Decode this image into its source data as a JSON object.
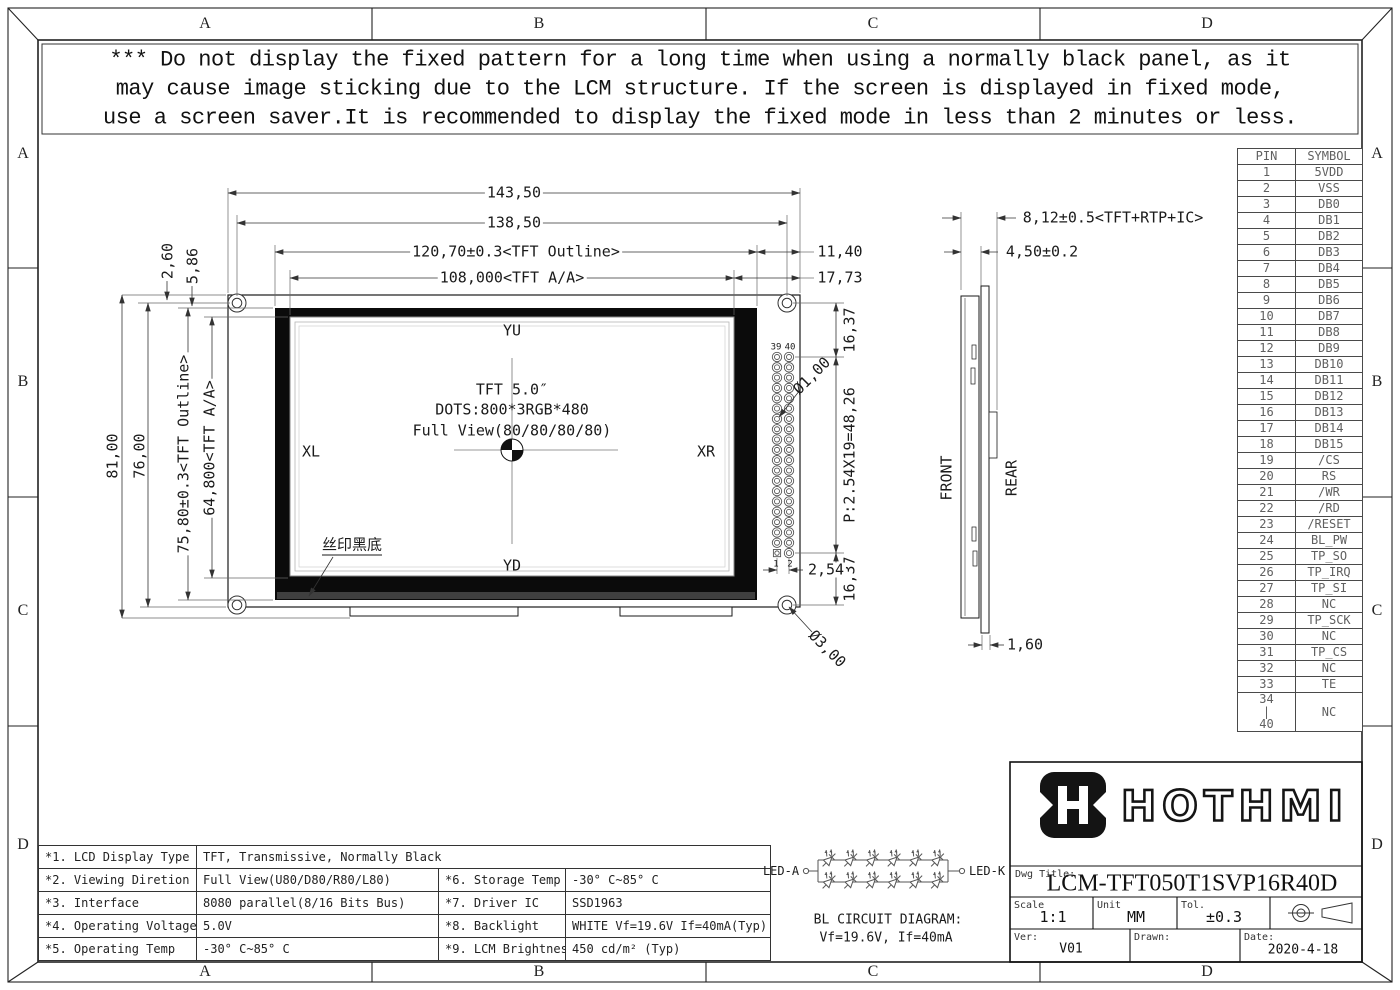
{
  "drawing": {
    "zones_top": [
      "A",
      "B",
      "C",
      "D"
    ],
    "zones_bottom": [
      "A",
      "B",
      "C",
      "D"
    ],
    "zones_left": [
      "A",
      "B",
      "C",
      "D"
    ],
    "zones_right": [
      "A",
      "B",
      "C",
      "D"
    ]
  },
  "warning": {
    "line1": "*** Do not display the fixed pattern for a long time when using a normally black panel, as it",
    "line2": "may cause image sticking due to the LCM structure. If the screen is displayed in fixed mode,",
    "line3": "use a screen saver.It is recommended to display the fixed mode in less than 2 minutes or less."
  },
  "front_view": {
    "label_yu": "YU",
    "label_yd": "YD",
    "label_xl": "XL",
    "label_xr": "XR",
    "panel_line1": "TFT 5.0″",
    "panel_line2": "DOTS:800*3RGB*480",
    "panel_line3": "Full View(80/80/80/80)",
    "silkprint": "丝印黑底",
    "pin39": "39",
    "pin40": "40",
    "pin1": "1",
    "pin2": "2"
  },
  "dims": {
    "w_total": "143,50",
    "w_holes": "138,50",
    "w_tft": "120,70±0.3<TFT Outline>",
    "w_aa": "108,000<TFT A/A>",
    "w_right1": "11,40",
    "w_right2": "17,73",
    "h_top1": "2,60",
    "h_top2": "5,86",
    "h_total": "81,00",
    "h_holes": "76,00",
    "h_tft": "75,80±0.3<TFT Outline>",
    "h_aa": "64,800<TFT A/A>",
    "conn_top": "16,37",
    "conn_pitch": "P:2.54X19=48,26",
    "conn_bottom": "16,37",
    "conn_pitch_h": "2,54",
    "dia_pin": "Ø1,00",
    "dia_hole": "Ø3,00",
    "t_total": "8,12±0.5<TFT+RTP+IC>",
    "t_front": "4,50±0.2",
    "t_pcb": "1,60"
  },
  "side_view": {
    "front": "FRONT",
    "rear": "REAR"
  },
  "pin_table": {
    "h_pin": "PIN",
    "h_symbol": "SYMBOL",
    "rows": [
      {
        "pin": "1",
        "symbol": "5VDD"
      },
      {
        "pin": "2",
        "symbol": "VSS"
      },
      {
        "pin": "3",
        "symbol": "DB0"
      },
      {
        "pin": "4",
        "symbol": "DB1"
      },
      {
        "pin": "5",
        "symbol": "DB2"
      },
      {
        "pin": "6",
        "symbol": "DB3"
      },
      {
        "pin": "7",
        "symbol": "DB4"
      },
      {
        "pin": "8",
        "symbol": "DB5"
      },
      {
        "pin": "9",
        "symbol": "DB6"
      },
      {
        "pin": "10",
        "symbol": "DB7"
      },
      {
        "pin": "11",
        "symbol": "DB8"
      },
      {
        "pin": "12",
        "symbol": "DB9"
      },
      {
        "pin": "13",
        "symbol": "DB10"
      },
      {
        "pin": "14",
        "symbol": "DB11"
      },
      {
        "pin": "15",
        "symbol": "DB12"
      },
      {
        "pin": "16",
        "symbol": "DB13"
      },
      {
        "pin": "17",
        "symbol": "DB14"
      },
      {
        "pin": "18",
        "symbol": "DB15"
      },
      {
        "pin": "19",
        "symbol": "/CS"
      },
      {
        "pin": "20",
        "symbol": "RS"
      },
      {
        "pin": "21",
        "symbol": "/WR"
      },
      {
        "pin": "22",
        "symbol": "/RD"
      },
      {
        "pin": "23",
        "symbol": "/RESET"
      },
      {
        "pin": "24",
        "symbol": "BL_PW"
      },
      {
        "pin": "25",
        "symbol": "TP_SO"
      },
      {
        "pin": "26",
        "symbol": "TP_IRQ"
      },
      {
        "pin": "27",
        "symbol": "TP_SI"
      },
      {
        "pin": "28",
        "symbol": "NC"
      },
      {
        "pin": "29",
        "symbol": "TP_SCK"
      },
      {
        "pin": "30",
        "symbol": "NC"
      },
      {
        "pin": "31",
        "symbol": "TP_CS"
      },
      {
        "pin": "32",
        "symbol": "NC"
      },
      {
        "pin": "33",
        "symbol": "TE"
      },
      {
        "pin": "34\n|\n40",
        "symbol": "NC"
      }
    ]
  },
  "spec_table": {
    "r1c1": "*1. LCD Display Type",
    "r1c2": "TFT, Transmissive, Normally Black",
    "r2c1": "*2. Viewing Diretion",
    "r2c2": "Full View(U80/D80/R80/L80)",
    "r2c3": "*6. Storage Temp",
    "r2c4": "-30° C~85° C",
    "r3c1": "*3. Interface",
    "r3c2": "8080 parallel(8/16 Bits Bus)",
    "r3c3": "*7. Driver IC",
    "r3c4": "SSD1963",
    "r4c1": "*4. Operating Voltage",
    "r4c2": "5.0V",
    "r4c3": "*8. Backlight",
    "r4c4": "WHITE Vf=19.6V If=40mA(Typ)",
    "r5c1": "*5. Operating Temp",
    "r5c2": "-30° C~85° C",
    "r5c3": "*9. LCM Brightness",
    "r5c4": "450 cd/m² (Typ)"
  },
  "bl_circuit": {
    "led_a": "LED-A",
    "led_k": "LED-K",
    "title": "BL CIRCUIT DIAGRAM:",
    "subtitle": "Vf=19.6V, If=40mA"
  },
  "title_block": {
    "brand": "HOTHMI",
    "dwg_title_label": "Dwg Title:",
    "dwg_title": "LCM-TFT050T1SVP16R40D",
    "scale_label": "Scale",
    "scale": "1:1",
    "unit_label": "Unit",
    "unit": "MM",
    "tol_label": "Tol.",
    "tol": "±0.3",
    "ver_label": "Ver:",
    "ver": "V01",
    "drawn_label": "Drawn:",
    "date_label": "Date:",
    "date": "2020-4-18"
  }
}
